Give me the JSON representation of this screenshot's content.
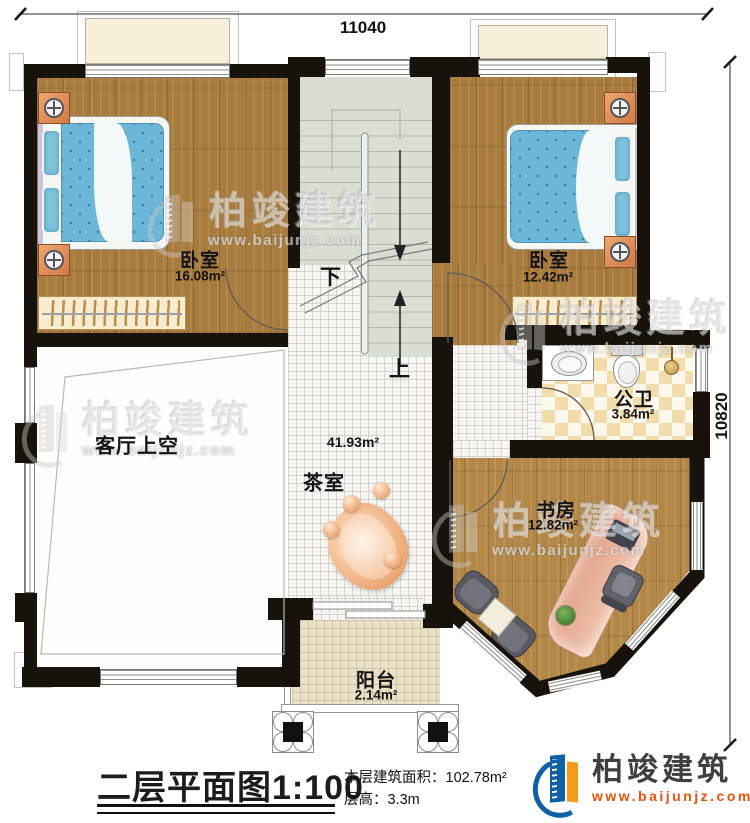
{
  "plan": {
    "dimension_top": "11040",
    "dimension_right": "10820"
  },
  "rooms": {
    "bedroom_left": {
      "name": "卧室",
      "area": "16.08m²"
    },
    "bedroom_right": {
      "name": "卧室",
      "area": "12.42m²"
    },
    "bathroom": {
      "name": "公卫",
      "area": "3.84m²"
    },
    "study": {
      "name": "书房",
      "area": "12.82m²"
    },
    "living_void": {
      "name": "客厅上空"
    },
    "tea_room": {
      "name": "茶室",
      "area": "41.93m²"
    },
    "balcony": {
      "name": "阳台",
      "area": "2.14m²"
    }
  },
  "stairs": {
    "down": "下",
    "up": "上"
  },
  "title_block": {
    "plan_name": "二层平面图",
    "scale": "1:100",
    "area_label": "本层建筑面积：",
    "area_value": "102.78m²",
    "height_label": "层高：",
    "height_value": "3.3m"
  },
  "brand": {
    "name": "柏竣建筑",
    "website": "www.baijunjz.com"
  },
  "watermark": {
    "name": "柏竣建筑",
    "website": "www.baijunjz.com"
  }
}
